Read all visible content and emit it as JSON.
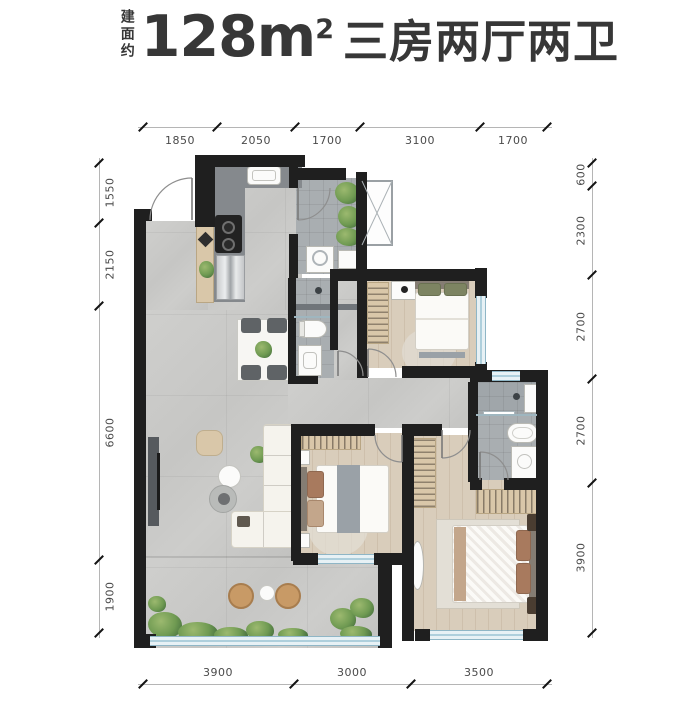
{
  "title": {
    "prefix_vertical": "建面约",
    "area": "128m",
    "area_sup": "2",
    "layout": "三房两厅两卫"
  },
  "dimensions": {
    "top": [
      "1850",
      "2050",
      "1700",
      "3100",
      "1700"
    ],
    "bottom": [
      "3900",
      "3000",
      "3500"
    ],
    "left": [
      "1550",
      "2150",
      "6600",
      "1900"
    ],
    "right": [
      "600",
      "2300",
      "2700",
      "2700",
      "3900"
    ]
  },
  "colors": {
    "wall": "#1f1f1f",
    "floor_tile": "#c9c9c7",
    "floor_wood": "#d9cdbb",
    "floor_bath": "#a9aeb1",
    "glass": "#aecfdc",
    "plant_green": "#6f9a52",
    "cabinet_tan": "#d9c7a9",
    "dimension_text": "#4a4a4a",
    "title_text": "#373737"
  }
}
